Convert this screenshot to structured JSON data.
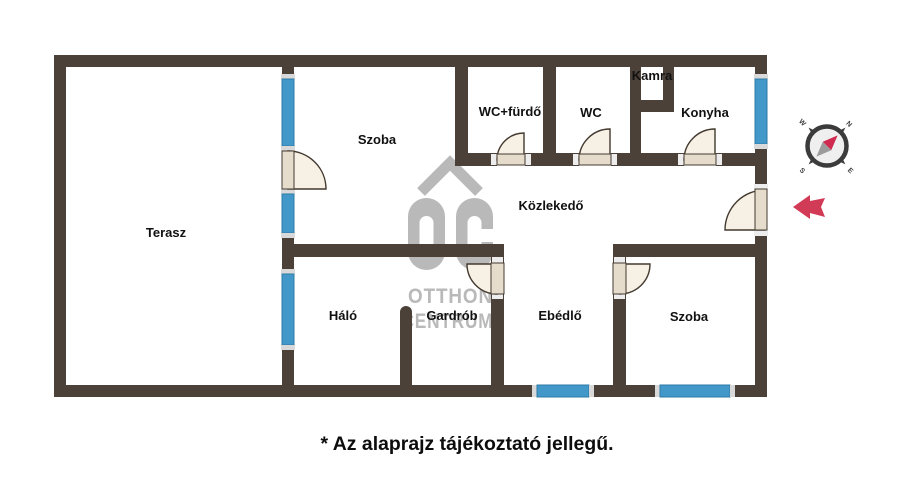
{
  "rooms": [
    {
      "name": "terasz",
      "label": "Terasz"
    },
    {
      "name": "szoba-felso",
      "label": "Szoba"
    },
    {
      "name": "wc-furdo",
      "label": "WC+fürdő"
    },
    {
      "name": "wc",
      "label": "WC"
    },
    {
      "name": "kamra",
      "label": "Kamra"
    },
    {
      "name": "konyha",
      "label": "Konyha"
    },
    {
      "name": "kozlekedo",
      "label": "Közlekedő"
    },
    {
      "name": "halo",
      "label": "Háló"
    },
    {
      "name": "gardrob",
      "label": "Gardrób"
    },
    {
      "name": "ebedlo",
      "label": "Ebédlő"
    },
    {
      "name": "szoba-also",
      "label": "Szoba"
    }
  ],
  "caption": {
    "text": "* Az alaprajz tájékoztató jellegű."
  },
  "watermark": {
    "logo_text": "OC",
    "line1": "OTTHON",
    "line2": "CENTRUM"
  },
  "compass": {
    "n": "N",
    "e": "E",
    "s": "S",
    "w": "W"
  },
  "colors": {
    "wall": "#4b4139",
    "window": "#4298c8",
    "window_edge": "#2e7aa8",
    "door_fill": "#f7f0e4",
    "door_leaf": "#e6dccb",
    "door_stroke": "#43392f",
    "watermark": "#b9b9b9",
    "arrow": "#d23b56",
    "compass_needle_red": "#cf2b50",
    "label": "#111111"
  }
}
